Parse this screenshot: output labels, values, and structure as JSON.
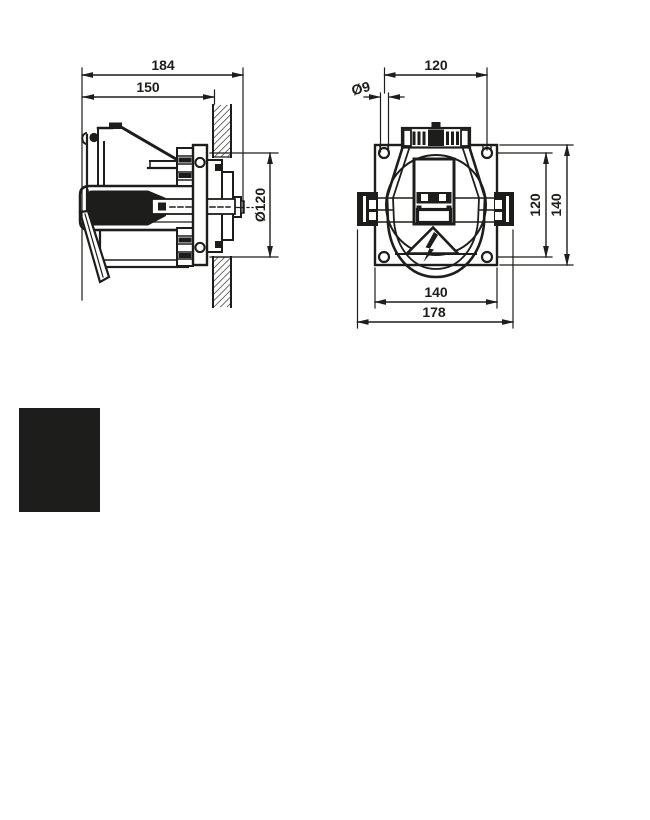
{
  "canvas": {
    "background_color": "#ffffff",
    "ink_color": "#1d1d1b"
  },
  "side_view": {
    "dim_overall_depth": "184",
    "dim_depth_to_wall": "150",
    "dim_flange_diameter": "Ø120"
  },
  "front_view": {
    "dim_top_hole_spacing": "120",
    "dim_hole_diameter": "Ø9",
    "dim_right_hole_spacing": "120",
    "dim_right_plate_height": "140",
    "dim_bottom_plate_width": "140",
    "dim_bottom_overall_width": "178"
  },
  "redaction_block": {
    "color": "#1d1d1b"
  }
}
